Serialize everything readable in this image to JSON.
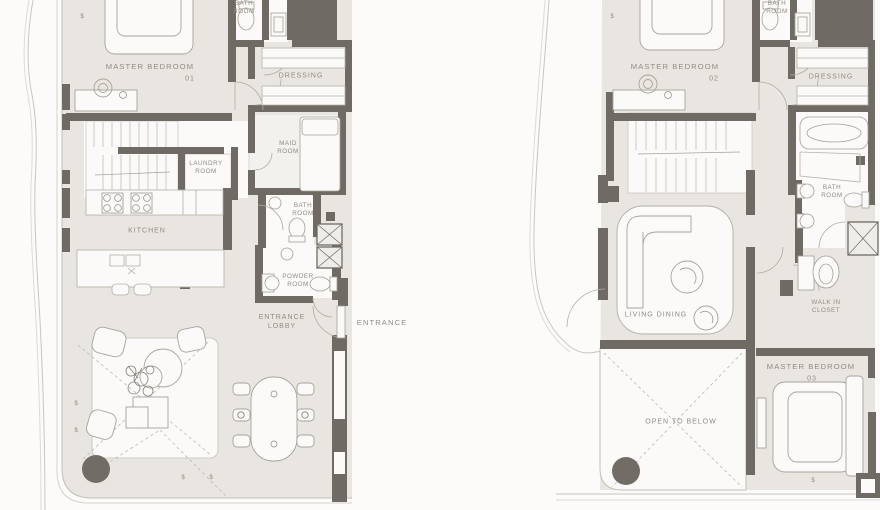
{
  "page": {
    "type": "architectural floor plan, two units side by side"
  },
  "colors": {
    "wall": "#6f6b64",
    "floor": "#e9e6e1",
    "room_white": "#fbfaf8",
    "thin_line": "#c7c4bd",
    "furniture_line": "#a7a39b",
    "label_text": "#908c85",
    "column": "#716d66"
  },
  "glyphs": {
    "section_mark": "$"
  },
  "unit_left": {
    "labels": {
      "bath_top": "BATH ROOM",
      "master_bedroom": "MASTER BEDROOM",
      "master_bedroom_no": "01",
      "dressing": "DRESSING",
      "maid_room": "MAID ROOM",
      "laundry_room": "LAUNDRY ROOM",
      "kitchen": "KITCHEN",
      "bath_mid": "BATH ROOM",
      "powder_room": "POWDER ROOM",
      "entrance_lobby": "ENTRANCE LOBBY",
      "entrance": "ENTRANCE"
    }
  },
  "unit_right": {
    "labels": {
      "bath_top": "BATH ROOM",
      "master_bedroom": "MASTER BEDROOM",
      "master_bedroom_no": "02",
      "dressing": "DRESSING",
      "bath": "BATH ROOM",
      "living_dining": "LIVING DINING",
      "walk_in_closet": "WALK IN CLOSET",
      "master_bedroom_03": "MASTER BEDROOM",
      "master_bedroom_03_no": "03",
      "open_to_below": "OPEN TO BELOW"
    }
  }
}
